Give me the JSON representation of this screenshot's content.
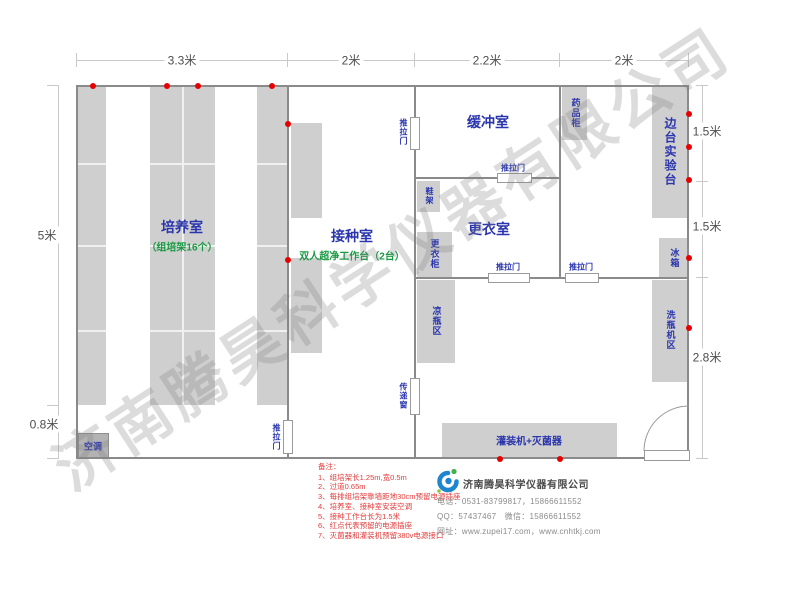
{
  "watermark": "济南腾昊科学仪器有限公司",
  "dimensions": {
    "top": [
      "3.3米",
      "2米",
      "2.2米",
      "2米"
    ],
    "left": [
      "5米",
      "0.8米"
    ],
    "right": [
      "1.5米",
      "1.5米",
      "2.8米"
    ]
  },
  "rooms": {
    "cultivation": {
      "name": "培养室",
      "subtitle": "（组培架16个）"
    },
    "inoculation": {
      "name": "接种室",
      "subtitle": "双人超净工作台（2台）"
    },
    "buffer_room": {
      "name": "缓冲室"
    },
    "dressing_room": {
      "name": "更衣室"
    }
  },
  "fixtures": {
    "medicine_cabinet": "药品柜",
    "side_lab_bench": "边台实验台",
    "fridge": "冰箱",
    "bottle_washing_area": "洗瓶机区",
    "bottle_cooling_area": "凉瓶区",
    "wardrobe": "更衣柜",
    "shoe_rack": "鞋架",
    "air_conditioner": "空调",
    "filling_sterilizer": "灌装机+灭菌器",
    "transfer_window": "传递窗",
    "sliding_door": "推拉门"
  },
  "notes": {
    "title": "备注：",
    "items": [
      "1、组培架长1.25m,宽0.5m",
      "2、过道0.65m",
      "3、每排组培架靠墙距地30cm预留电源插座",
      "4、培养室、接种室安装空调",
      "5、接种工作台长为1.5米",
      "6、红点代表预留的电源插座",
      "7、灭菌器和灌装机预留380v电源接口"
    ]
  },
  "company": {
    "name": "济南腾昊科学仪器有限公司",
    "phone": "电话：0531-83799817，15866611552",
    "qq": "QQ：57437467　微信：15866611552",
    "website": "网址：www.zupei17.com，www.cnhtkj.com"
  },
  "power_sockets": {
    "color": "#e60000",
    "positions": [
      [
        93,
        86
      ],
      [
        167,
        86
      ],
      [
        198,
        86
      ],
      [
        272,
        86
      ],
      [
        288,
        124
      ],
      [
        288,
        260
      ],
      [
        689,
        114
      ],
      [
        689,
        147
      ],
      [
        689,
        180
      ],
      [
        689,
        258
      ],
      [
        689,
        328
      ],
      [
        500,
        459
      ],
      [
        560,
        459
      ]
    ]
  }
}
